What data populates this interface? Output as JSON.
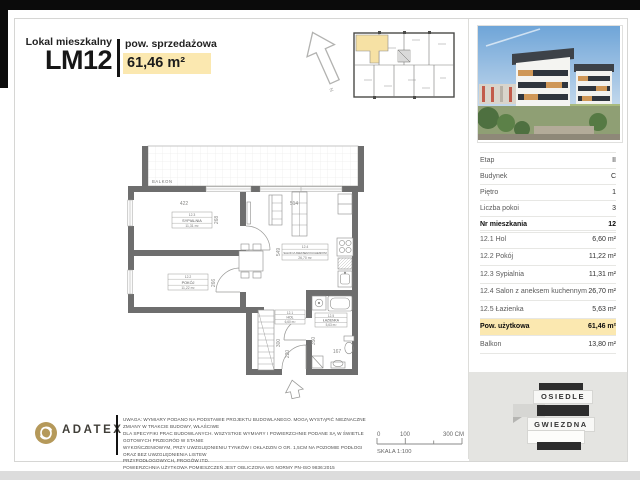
{
  "header": {
    "type_label": "Lokal mieszkalny",
    "unit_id": "LM12",
    "sale_area_label": "pow. sprzedażowa",
    "sale_area_value": "61,46 m²"
  },
  "summary": {
    "info_rows": [
      {
        "label": "Etap",
        "value": "II"
      },
      {
        "label": "Budynek",
        "value": "C"
      },
      {
        "label": "Piętro",
        "value": "1"
      },
      {
        "label": "Liczba pokoi",
        "value": "3"
      },
      {
        "label": "Nr mieszkania",
        "value": "12"
      }
    ],
    "room_rows": [
      {
        "label": "12.1 Hol",
        "value": "6,60 m²"
      },
      {
        "label": "12.2 Pokój",
        "value": "11,22 m²"
      },
      {
        "label": "12.3 Sypialnia",
        "value": "11,31 m²"
      },
      {
        "label": "12.4 Salon z aneksem kuchennym",
        "value": "26,70 m²"
      },
      {
        "label": "12.5 Łazienka",
        "value": "5,63 m²"
      }
    ],
    "total_row": {
      "label": "Pow. użytkowa",
      "value": "61,46 m²"
    },
    "balcony_row": {
      "label": "Balkon",
      "value": "13,80 m²"
    }
  },
  "plan": {
    "balcony_label": "BALKON",
    "north_label": "N",
    "dims": {
      "sypialnia_width": "422",
      "sypialnia_depth": "268",
      "salon_width": "514",
      "salon_depth": "549",
      "pokoj_depth": "266",
      "hol_depth": "300",
      "hol_width": "220",
      "lazienka_depth": "350",
      "lazienka_width": "167"
    },
    "labels": {
      "sypialnia": {
        "number": "12.3",
        "name": "SYPIALNIA",
        "area": "11,31 m²"
      },
      "pokoj": {
        "number": "12.2",
        "name": "POKÓJ",
        "area": "11,22 m²"
      },
      "salon": {
        "number": "12.4",
        "name": "SALON Z ANEKSEM KUCHENNYM",
        "area": "26,70 m²"
      },
      "hol": {
        "number": "12.1",
        "name": "HOL",
        "area": "6,60 m²"
      },
      "lazienka": {
        "number": "12.5",
        "name": "ŁAZIENKA",
        "area": "5,63 m²"
      }
    }
  },
  "footer": {
    "brand": "ADATEX",
    "disclaimer_lines": [
      "UWAGA: WYMIARY PODANO NA PODSTAWIE PROJEKTU BUDOWLANEGO. MOGĄ WYSTĄPIĆ NIEZNACZNE ZMIANY W TRAKCIE BUDOWY, WŁAŚCIWE",
      "DLA SPECYFIKI PRAC BUDOWLANYCH. WSZYSTKIE WYMIARY I POWIERZCHNIE PODANE SĄ W ŚWIETLE GOTOWYCH PRZEGRÓD W STANIE",
      "WYKOŃCZENIOWYM, PRZY UWZGLĘDNIENIU TYNKÓW I OKŁADZIN O GR. 1,5CM NA POZIOMIE PODŁOGI ORAZ BEZ UWZGLĘDNIENIA LISTEW",
      "PRZYPODŁOGOWYCH, PROGÓW ITD.",
      "POWIERZCHNIA UŻYTKOWA POMIESZCZEŃ JEST OBLICZONA WG NORMY PN-ISO 9836:2015"
    ],
    "scale_ticks": [
      "0",
      "100",
      "300 CM"
    ],
    "scale_label": "SKALA 1:100"
  },
  "estate": {
    "line1": "OSIEDLE",
    "line2": "GWIEZDNA"
  },
  "colors": {
    "accent_yellow": "#FBE8B0",
    "wall_gray": "#6E6E6E",
    "logo_gold": "#B5995A"
  }
}
